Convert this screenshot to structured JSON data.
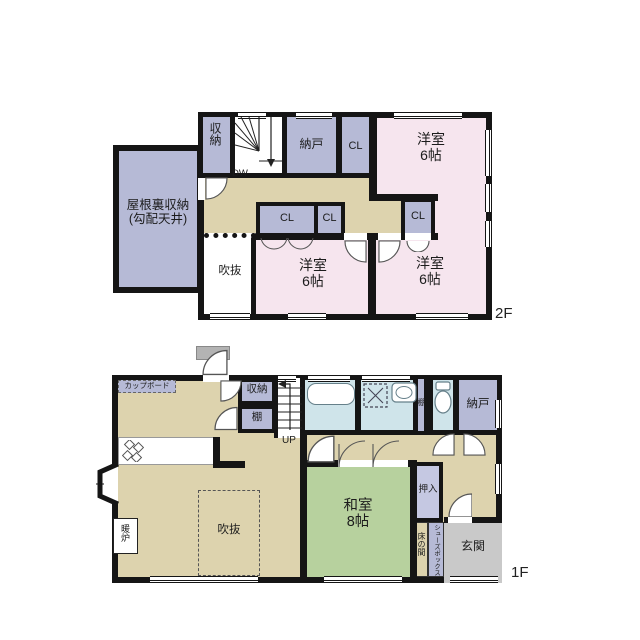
{
  "title": "2-story house floor plan",
  "colors": {
    "wall": "#151515",
    "paper": "#ffffff",
    "pink": "#f6e5ee",
    "lavender": "#b6bad6",
    "lavender-light": "#c5c8e2",
    "tan": "#ddd3ae",
    "green": "#b7d19e",
    "blue": "#cfe4ea",
    "gray": "#c9c9c9",
    "awning": "#b3b3b3"
  },
  "floor2": {
    "floor_label": "2F",
    "attic": {
      "line1": "屋根裏収納",
      "line2": "(勾配天井)"
    },
    "shunou": "収納",
    "dw": "DW",
    "nando": "納戸",
    "cl_top": "CL",
    "room_top_right": {
      "name": "洋室",
      "size": "6帖"
    },
    "cl_mid1": "CL",
    "cl_mid2": "CL",
    "cl_right": "CL",
    "fukinuke": "吹抜",
    "room_bottom_left": {
      "name": "洋室",
      "size": "6帖"
    },
    "room_bottom_right": {
      "name": "洋室",
      "size": "6帖"
    }
  },
  "floor1": {
    "floor_label": "1F",
    "cupboard": "カップボード",
    "shunou": "収納",
    "tana": "棚",
    "up": "UP",
    "tana_small": "棚",
    "nando": "納戸",
    "oshiire": "押入",
    "washitsu": {
      "name": "和室",
      "size": "8帖"
    },
    "tokonoma": "床の間",
    "shoebox": "シューズボックス",
    "genkan": "玄関",
    "danro": "暖炉",
    "fukinuke": "吹抜"
  }
}
